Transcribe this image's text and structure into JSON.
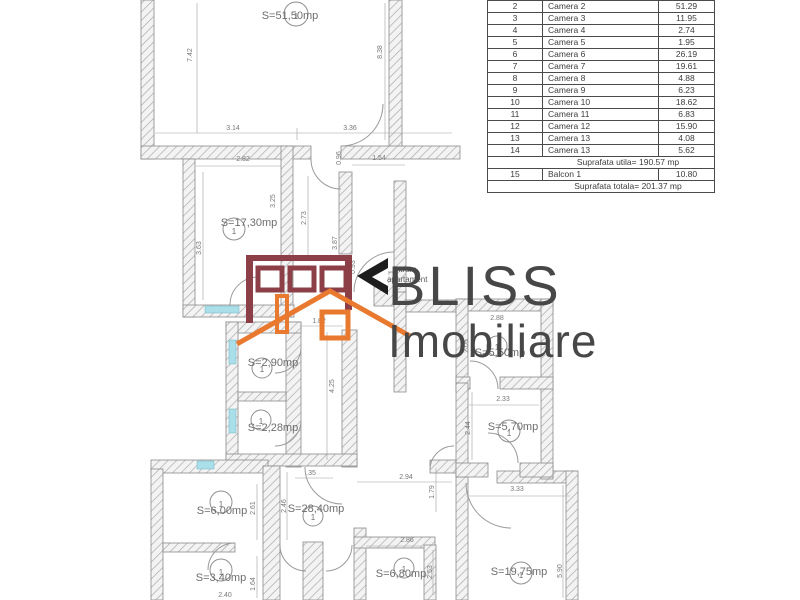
{
  "colors": {
    "maroon": "#8d3f47",
    "orange": "#e8792e",
    "sill": "#aadee8",
    "brand_text": "#474747"
  },
  "watermark": {
    "brand_line1": "BLISS",
    "brand_line2": "Imobiliare",
    "entry_label_line1": "intrare",
    "entry_label_line2": "apartament"
  },
  "table": {
    "rows": [
      {
        "no": "2",
        "name": "Camera 2",
        "value": "51.29"
      },
      {
        "no": "3",
        "name": "Camera 3",
        "value": "11.95"
      },
      {
        "no": "4",
        "name": "Camera 4",
        "value": "2.74"
      },
      {
        "no": "5",
        "name": "Camera 5",
        "value": "1.95"
      },
      {
        "no": "6",
        "name": "Camera 6",
        "value": "26.19"
      },
      {
        "no": "7",
        "name": "Camera 7",
        "value": "19.61"
      },
      {
        "no": "8",
        "name": "Camera 8",
        "value": "4.88"
      },
      {
        "no": "9",
        "name": "Camera 9",
        "value": "6.23"
      },
      {
        "no": "10",
        "name": "Camera 10",
        "value": "18.62"
      },
      {
        "no": "11",
        "name": "Camera 11",
        "value": "6.83"
      },
      {
        "no": "12",
        "name": "Camera 12",
        "value": "15.90"
      },
      {
        "no": "13",
        "name": "Camera 13",
        "value": "4.08"
      },
      {
        "no": "14",
        "name": "Camera 13",
        "value": "5.62"
      },
      {
        "merged": "Suprafata utila= 190.57 mp"
      },
      {
        "no": "15",
        "name": "Balcon 1",
        "value": "10.80"
      },
      {
        "merged": "Suprafata totala= 201.37 mp"
      }
    ]
  },
  "rooms": [
    {
      "area": "S=51,50mp",
      "num": "1"
    },
    {
      "area": "S=17,30mp",
      "num": "1"
    },
    {
      "area": "S=2,90mp",
      "num": "1"
    },
    {
      "area": "S=2,28mp",
      "num": "1"
    },
    {
      "area": "S=6,00mp",
      "num": "1"
    },
    {
      "area": "S=3,40mp",
      "num": "1"
    },
    {
      "area": "S=28,40mp",
      "num": "1"
    },
    {
      "area": "S=6,80mp",
      "num": "1"
    },
    {
      "area": "S=5,50mp",
      "num": "1"
    },
    {
      "area": "S=5,70mp",
      "num": "1"
    },
    {
      "area": "S=19,75mp",
      "num": "1"
    }
  ],
  "dims": [
    "7.42",
    "8.38",
    "3.14",
    "3.36",
    "2.82",
    "0.96",
    "1.54",
    "3.25",
    "2.73",
    "3.87",
    "3.63",
    "0.93",
    "1.82",
    "4.25",
    "2.88",
    "2.05",
    "2.33",
    "2.44",
    ".35",
    "2.94",
    "1.79",
    "3.33",
    "2.46",
    "2.61",
    "1.64",
    "2.40",
    "2.86",
    "2.53",
    "5.90"
  ]
}
